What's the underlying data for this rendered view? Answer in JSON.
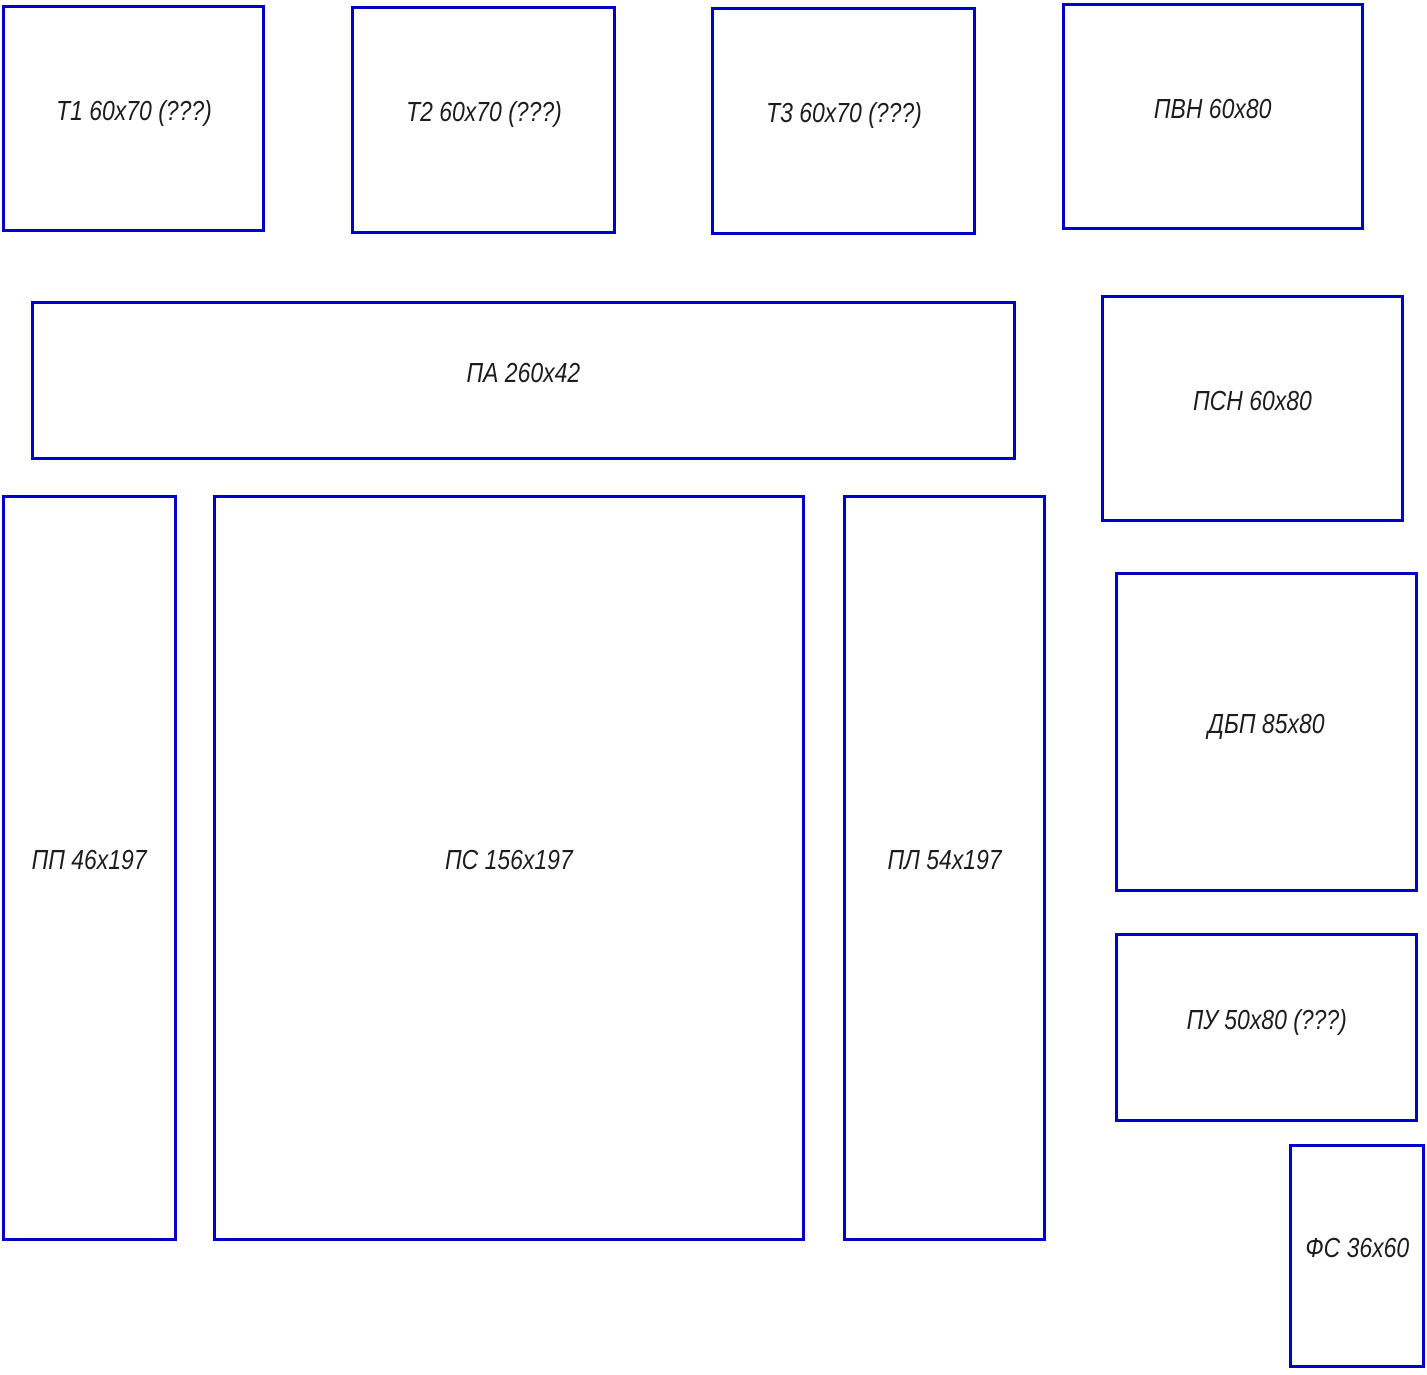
{
  "diagram": {
    "type": "panel-cutting-layout",
    "outline_color": "#0000c8",
    "text_color": "#1c1c1c",
    "background_color": "#ffffff"
  },
  "boxes": [
    {
      "id": "t1",
      "label": "Т1 60х70 (???)"
    },
    {
      "id": "t2",
      "label": "Т2 60х70 (???)"
    },
    {
      "id": "t3",
      "label": "Т3 60х70 (???)"
    },
    {
      "id": "pvn",
      "label": "ПВН 60х80"
    },
    {
      "id": "pa",
      "label": "ПА 260х42"
    },
    {
      "id": "psn",
      "label": "ПСН 60х80"
    },
    {
      "id": "pp",
      "label": "ПП 46х197"
    },
    {
      "id": "ps",
      "label": "ПС 156х197"
    },
    {
      "id": "pl",
      "label": "ПЛ 54х197"
    },
    {
      "id": "dbp",
      "label": "ДБП 85х80"
    },
    {
      "id": "pu",
      "label": "ПУ 50х80 (???)"
    },
    {
      "id": "fs",
      "label": "ФС 36х60"
    }
  ]
}
